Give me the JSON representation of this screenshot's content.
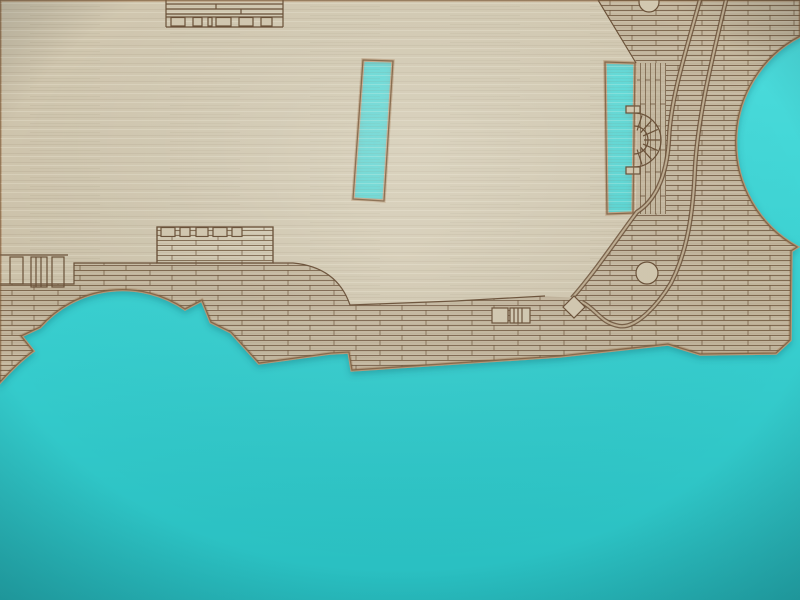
{
  "scene": {
    "description": "Close-up photograph of a laser-cut and laser-engraved wooden model-ship deck sheet lying on a bright cyan background",
    "subject": "wooden deck part with engraved planking",
    "background": "plain cyan surface"
  },
  "palette": {
    "cyan_top": "#4edddd",
    "cyan_mid": "#3bd2d2",
    "cyan_bottom": "#28bec0",
    "wood_base": "#cdc3ab",
    "wood_light": "#d2c8b0",
    "planked_wood": "#b2a288",
    "engraving_line": "#6b5138",
    "cut_edge": "#7a5c3e",
    "cut_bevel": "#b59877",
    "double_line_gap": "#bfae92"
  },
  "objects": {
    "deck_sheet": "laser-cut plywood deck sheet",
    "left_slot_cutout": "rectangular mast slot",
    "right_slot_cutout": "rectangular mast slot",
    "round_cutout": "large circular cutout at right edge",
    "arch_cutout": "scalloped arch cutout at bottom left",
    "engravings": [
      "stern structure at top edge",
      "deck cabin with window row",
      "mooring fittings at left edge",
      "sunburst fan beside right slot",
      "round deck fitting",
      "diamond fitting",
      "ladder and hatch",
      "curved margin plank double lines",
      "dense deck planking with butt joints"
    ]
  }
}
